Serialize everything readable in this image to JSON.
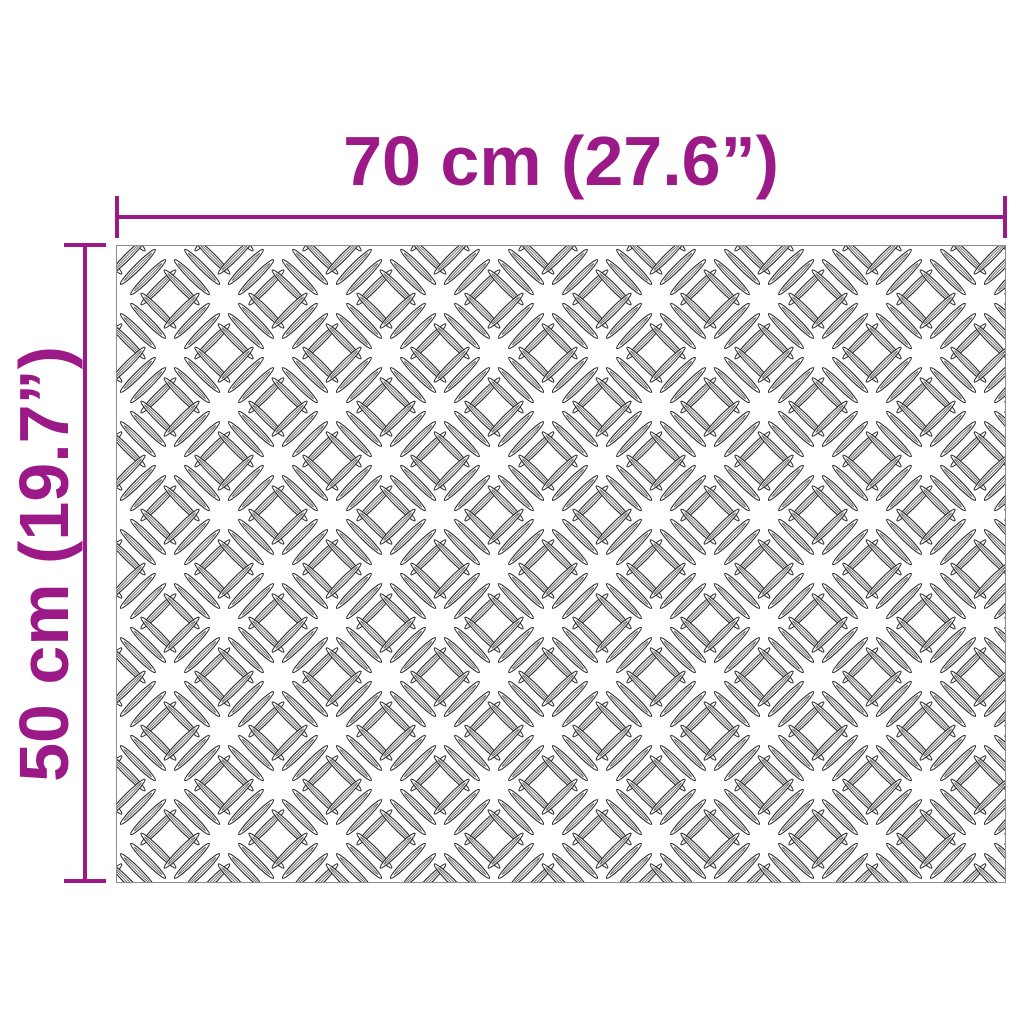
{
  "diagram": {
    "kind": "product-dimension-diagram",
    "subject": "checker-plate-sheet",
    "width_dimension": {
      "label": "70 cm (27.6”)"
    },
    "height_dimension": {
      "label": "50 cm (19.7”)"
    }
  },
  "colors": {
    "dimension_accent": "#9b1a88",
    "background": "#ffffff",
    "plate_border": "#8c8c8c",
    "pattern_outline": "#2d2d2d",
    "pattern_inner": "#6e6e6e"
  }
}
